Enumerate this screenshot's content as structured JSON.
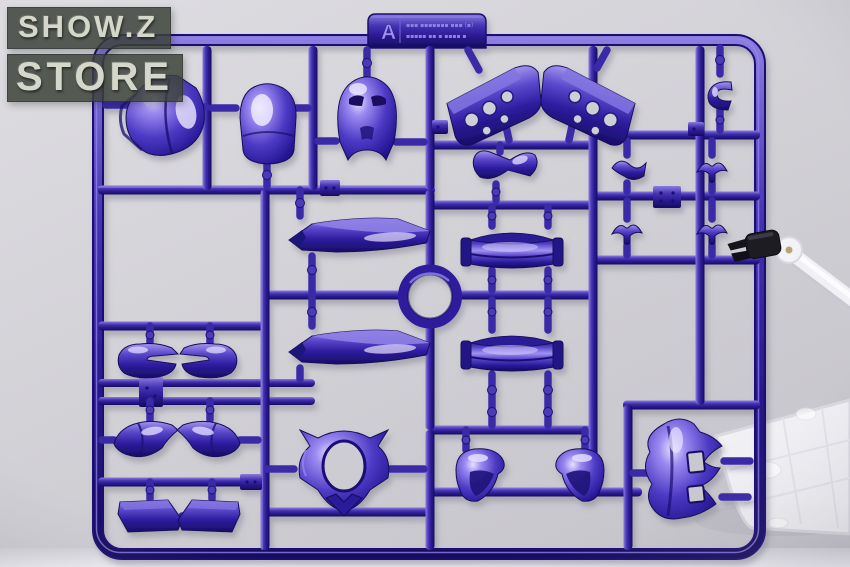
{
  "watermark": {
    "line1": "SHOW.Z",
    "line2": "STORE"
  },
  "runner_tag": {
    "letter": "A",
    "info_line1": "▪▪▪  ▪▪▪▪▪▪▪  ▪▪▪ (▪)",
    "info_line2": "▪▪▪▪▪  ▪▪ ▪ ▪▪▪▪ ▪"
  },
  "palette": {
    "plastic_mid": "#32219c",
    "plastic_dark": "#170d66",
    "plastic_highlight": "#9c8df0",
    "background": "#d2d1d6",
    "floor": "#edecf1",
    "stand_clear": "#f4f3f7",
    "clamp_black": "#1b1a20",
    "watermark_text": "#d5d7cb",
    "watermark_bg": "#3d423c"
  },
  "runner_parts": [
    "chest-armor",
    "head-cowl",
    "helmet",
    "vent-plate-left",
    "vent-plate-right",
    "c-clip",
    "s-joint",
    "wing-joint-top-right",
    "wing-joint-bottom-left",
    "wing-joint-bottom-right",
    "blade-upper",
    "blade-lower",
    "waist-twist",
    "drum-upper",
    "drum-lower",
    "ring-junction",
    "eye-mask-left",
    "eye-mask-right",
    "curved-armor-left",
    "curved-armor-right",
    "skirt-plate-left",
    "skirt-plate-right",
    "waist-ring-frame",
    "shoulder-pad-left",
    "shoulder-pad-right",
    "bat-cowl"
  ],
  "stand": {
    "pieces": [
      "clear-base-plate",
      "clear-articulated-arm",
      "black-clamp"
    ]
  }
}
